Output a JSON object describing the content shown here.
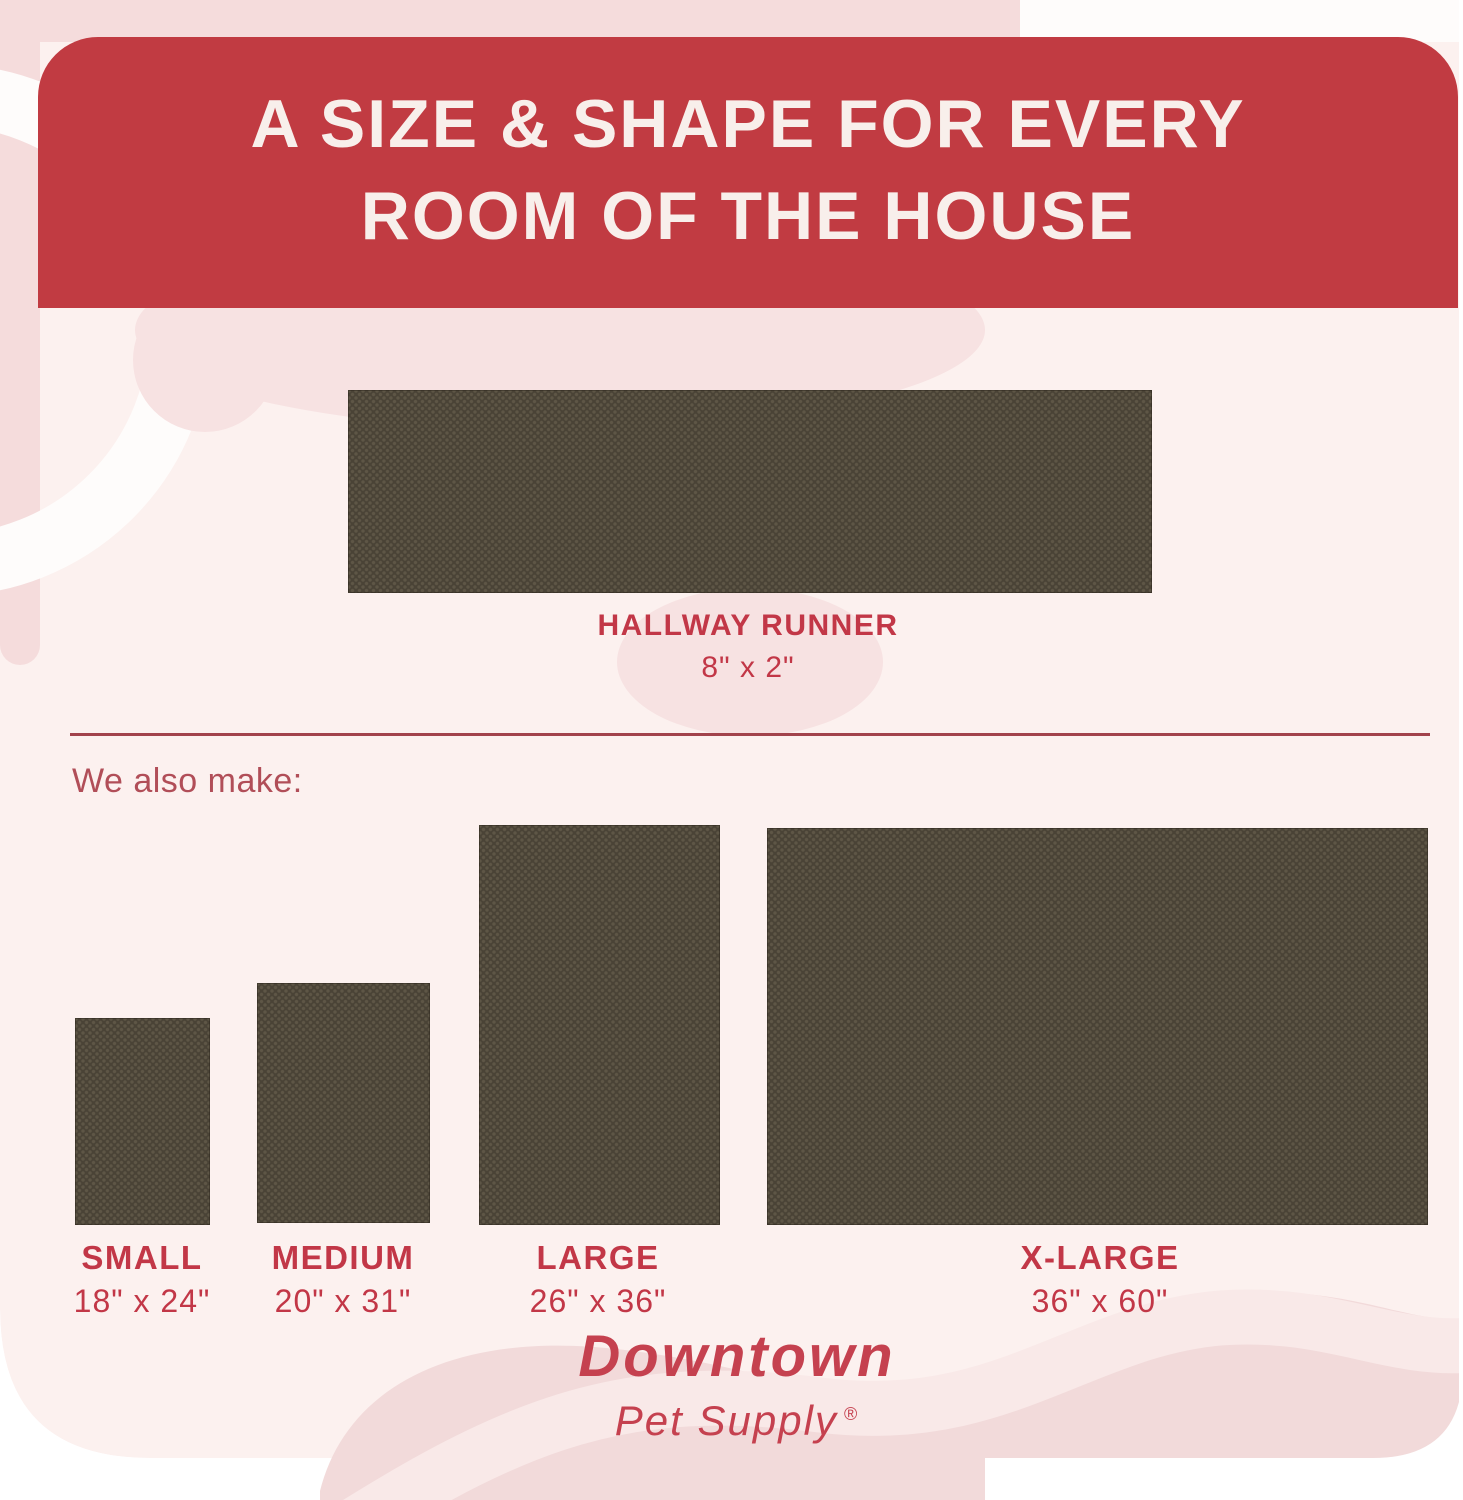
{
  "header": {
    "title_line1": "A SIZE & SHAPE FOR EVERY",
    "title_line2": "ROOM OF THE HOUSE"
  },
  "runner": {
    "name": "HALLWAY RUNNER",
    "dims": "8\" x 2\""
  },
  "also_make_label": "We also make:",
  "sizes": {
    "items": [
      {
        "name": "SMALL",
        "dims": "18\" x 24\""
      },
      {
        "name": "MEDIUM",
        "dims": "20\" x 31\""
      },
      {
        "name": "LARGE",
        "dims": "26\" x 36\""
      },
      {
        "name": "X-LARGE",
        "dims": "36\" x 60\""
      }
    ]
  },
  "brand": {
    "line1": "Downtown",
    "line2": "Pet Supply",
    "registered": "®"
  },
  "colors": {
    "header_bg": "#c13b42",
    "header_text": "#f8efeb",
    "accent_red": "#c23747",
    "muted_red": "#b14e58",
    "divider_red": "#a2434c",
    "brand_red": "#c5414f",
    "mat_base": "#4a4336",
    "mat_dot": "#5e5646",
    "canvas_bg": "#fcf1ef",
    "blob_pink": "#f5dcdc",
    "blob_pink_soft": "#f7e2e2",
    "band_light": "#f9e9e8",
    "page_bg": "#ffffff"
  }
}
